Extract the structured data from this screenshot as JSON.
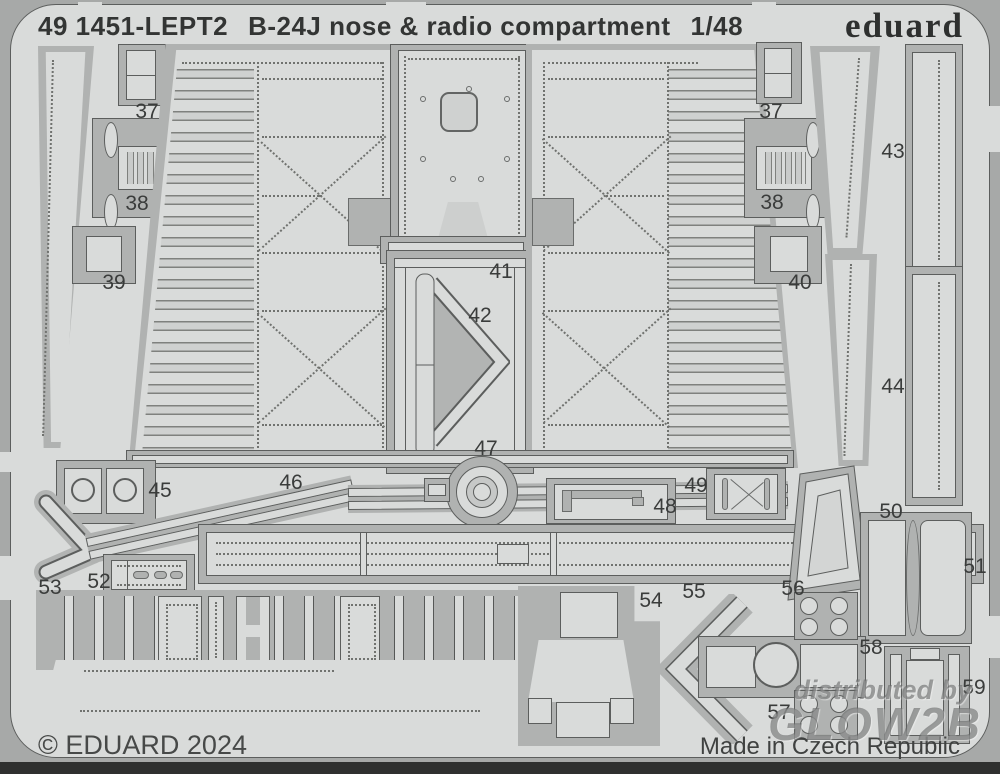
{
  "sheet": {
    "header": {
      "catalog_no": "49 1451-LEPT2",
      "title": "B-24J nose & radio compartment",
      "scale": "1/48"
    },
    "brand_logo": "eduard",
    "footer": {
      "copyright": "© EDUARD 2024",
      "origin": "Made in Czech Republic"
    },
    "watermark": {
      "line1": "distributed by",
      "line2": "GLOW2B"
    },
    "colors": {
      "sheet_field": "#d9dbda",
      "etched_moat": "#b0b2b1",
      "frame_band": "#a7a9a8",
      "outline": "#5c5e5d",
      "dark_strip": "#2f302f",
      "text": "#3a3c3b"
    },
    "part_labels": [
      {
        "label": "37",
        "position": "upper-left"
      },
      {
        "label": "38",
        "position": "upper-left"
      },
      {
        "label": "39",
        "position": "left"
      },
      {
        "label": "41",
        "position": "center"
      },
      {
        "label": "42",
        "position": "center"
      },
      {
        "label": "37",
        "position": "upper-right"
      },
      {
        "label": "38",
        "position": "upper-right"
      },
      {
        "label": "40",
        "position": "right"
      },
      {
        "label": "43",
        "position": "right-column"
      },
      {
        "label": "44",
        "position": "right-column"
      },
      {
        "label": "45",
        "position": "lower-left"
      },
      {
        "label": "46",
        "position": "lower-left"
      },
      {
        "label": "47",
        "position": "lower-center"
      },
      {
        "label": "48",
        "position": "lower-center"
      },
      {
        "label": "49",
        "position": "lower-center"
      },
      {
        "label": "50",
        "position": "lower-right"
      },
      {
        "label": "51",
        "position": "lower-right"
      },
      {
        "label": "52",
        "position": "bottom-left"
      },
      {
        "label": "53",
        "position": "bottom-left"
      },
      {
        "label": "54",
        "position": "bottom-center"
      },
      {
        "label": "55",
        "position": "bottom-center"
      },
      {
        "label": "56",
        "position": "bottom-right"
      },
      {
        "label": "57",
        "position": "bottom-right"
      },
      {
        "label": "58",
        "position": "bottom-right"
      },
      {
        "label": "59",
        "position": "bottom-right"
      }
    ]
  }
}
